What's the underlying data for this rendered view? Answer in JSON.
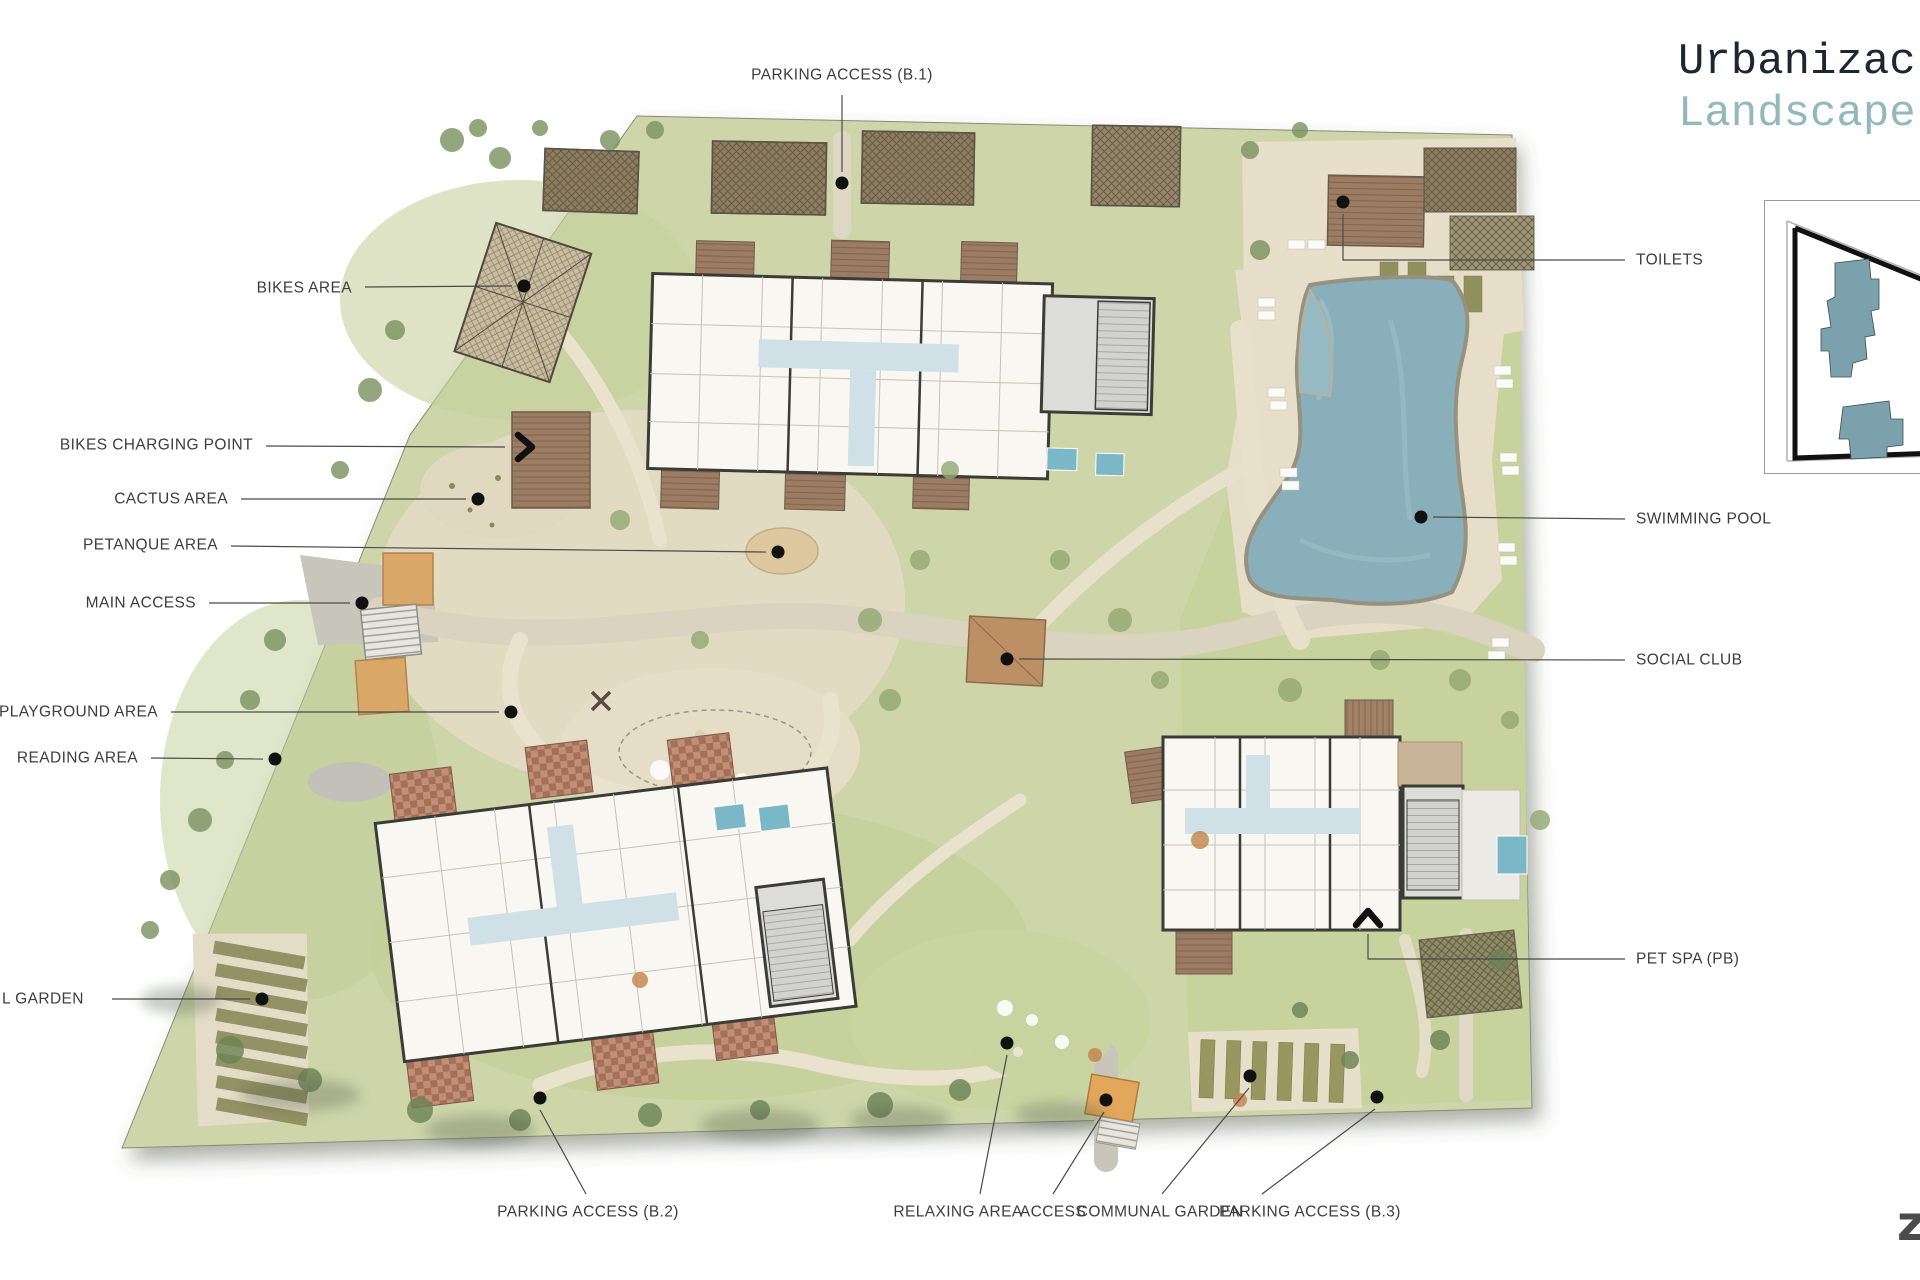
{
  "canvas": {
    "width": 1920,
    "height": 1280
  },
  "title": {
    "line1": "Urbanizac",
    "line2": "Landscape"
  },
  "corner_mark": "z",
  "palette": {
    "ground": "#cdd5a9",
    "lawn": "#c4d09a",
    "sand": "#e5ddc6",
    "path": "#e9e2cd",
    "road": "#c9c6bb",
    "pool_water": "#88afba",
    "plunge_pool": "#7ab8c8",
    "building_fill": "#f8f7f2",
    "building_wall": "#3b3b37",
    "terrace_wood": "#9c7d64",
    "terrace_checker": "#a5705a",
    "annex_gray": "#dcdcd9",
    "canopy_tan": "#d9a869",
    "social_club_roof": "#bc9064",
    "garden_olive": "#90905c",
    "label_text": "#3d3d3d",
    "leader_line": "#4a4a4a",
    "marker_dot": "#111111",
    "title_dark": "#1c2733",
    "title_teal": "#93b8bc",
    "inset_building_teal": "#7ba2ac"
  },
  "labels": [
    {
      "id": "bikes-area",
      "text": "BIKES AREA",
      "anchor": "end",
      "tx": 352,
      "ty": 288,
      "line": [
        [
          365,
          287
        ],
        [
          512,
          286
        ]
      ],
      "marker": "dot",
      "mx": 524,
      "my": 286
    },
    {
      "id": "bikes-charging-point",
      "text": "BIKES CHARGING POINT",
      "anchor": "end",
      "tx": 253,
      "ty": 445,
      "line": [
        [
          266,
          446
        ],
        [
          505,
          447
        ]
      ],
      "marker": "chevron-right",
      "mx": 527,
      "my": 447
    },
    {
      "id": "cactus-area",
      "text": "CACTUS AREA",
      "anchor": "end",
      "tx": 228,
      "ty": 499,
      "line": [
        [
          241,
          499
        ],
        [
          466,
          499
        ]
      ],
      "marker": "dot",
      "mx": 478,
      "my": 499
    },
    {
      "id": "petanque-area",
      "text": "PETANQUE AREA",
      "anchor": "end",
      "tx": 218,
      "ty": 545,
      "line": [
        [
          231,
          546
        ],
        [
          766,
          552
        ]
      ],
      "marker": "dot",
      "mx": 778,
      "my": 552
    },
    {
      "id": "main-access",
      "text": "MAIN ACCESS",
      "anchor": "end",
      "tx": 196,
      "ty": 603,
      "line": [
        [
          209,
          603
        ],
        [
          350,
          603
        ]
      ],
      "marker": "dot",
      "mx": 362,
      "my": 603
    },
    {
      "id": "playground-area",
      "text": "PLAYGROUND AREA",
      "anchor": "end",
      "tx": 158,
      "ty": 712,
      "line": [
        [
          171,
          712
        ],
        [
          499,
          712
        ]
      ],
      "marker": "dot",
      "mx": 511,
      "my": 712
    },
    {
      "id": "reading-area",
      "text": "READING AREA",
      "anchor": "end",
      "tx": 138,
      "ty": 758,
      "line": [
        [
          151,
          758
        ],
        [
          263,
          759
        ]
      ],
      "marker": "dot",
      "mx": 275,
      "my": 759
    },
    {
      "id": "communal-garden-left",
      "text": "L GARDEN",
      "anchor": "start",
      "tx": 2,
      "ty": 999,
      "line": [
        [
          112,
          999
        ],
        [
          250,
          999
        ]
      ],
      "marker": "dot",
      "mx": 262,
      "my": 999
    },
    {
      "id": "parking-access-b1",
      "text": "PARKING ACCESS (B.1)",
      "anchor": "middle",
      "tx": 842,
      "ty": 75,
      "line": [
        [
          842,
          95
        ],
        [
          842,
          172
        ]
      ],
      "marker": "dot",
      "mx": 842,
      "my": 183
    },
    {
      "id": "parking-access-b2",
      "text": "PARKING ACCESS (B.2)",
      "anchor": "middle",
      "tx": 588,
      "ty": 1212,
      "line": [
        [
          586,
          1194
        ],
        [
          540,
          1110
        ]
      ],
      "marker": "dot",
      "mx": 540,
      "my": 1098
    },
    {
      "id": "relaxing-area",
      "text": "RELAXING AREA",
      "anchor": "middle",
      "tx": 958,
      "ty": 1212,
      "line": [
        [
          980,
          1194
        ],
        [
          1007,
          1055
        ]
      ],
      "marker": "dot",
      "mx": 1007,
      "my": 1043
    },
    {
      "id": "access",
      "text": "ACCESS",
      "anchor": "middle",
      "tx": 1053,
      "ty": 1212,
      "line": [
        [
          1053,
          1194
        ],
        [
          1104,
          1112
        ]
      ],
      "marker": "dot",
      "mx": 1106,
      "my": 1100
    },
    {
      "id": "communal-garden",
      "text": "COMMUNAL GARDEN",
      "anchor": "middle",
      "tx": 1160,
      "ty": 1212,
      "line": [
        [
          1162,
          1194
        ],
        [
          1249,
          1088
        ]
      ],
      "marker": "dot",
      "mx": 1250,
      "my": 1076
    },
    {
      "id": "parking-access-b3",
      "text": "PARKING ACCESS (B.3)",
      "anchor": "middle",
      "tx": 1310,
      "ty": 1212,
      "line": [
        [
          1262,
          1194
        ],
        [
          1375,
          1109
        ]
      ],
      "marker": "dot",
      "mx": 1377,
      "my": 1097
    },
    {
      "id": "toilets",
      "text": "TOILETS",
      "anchor": "start",
      "tx": 1636,
      "ty": 260,
      "line": [
        [
          1625,
          260
        ],
        [
          1343,
          260
        ],
        [
          1343,
          214
        ]
      ],
      "marker": "dot",
      "mx": 1343,
      "my": 202
    },
    {
      "id": "swimming-pool",
      "text": "SWIMMING POOL",
      "anchor": "start",
      "tx": 1636,
      "ty": 519,
      "line": [
        [
          1625,
          519
        ],
        [
          1433,
          517
        ]
      ],
      "marker": "dot",
      "mx": 1421,
      "my": 517
    },
    {
      "id": "social-club",
      "text": "SOCIAL CLUB",
      "anchor": "start",
      "tx": 1636,
      "ty": 660,
      "line": [
        [
          1625,
          660
        ],
        [
          1019,
          659
        ]
      ],
      "marker": "dot",
      "mx": 1007,
      "my": 659
    },
    {
      "id": "pet-spa",
      "text": "PET SPA (PB)",
      "anchor": "start",
      "tx": 1636,
      "ty": 959,
      "line": [
        [
          1625,
          959
        ],
        [
          1368,
          959
        ],
        [
          1368,
          934
        ]
      ],
      "marker": "chevron-up",
      "mx": 1368,
      "my": 916
    }
  ]
}
